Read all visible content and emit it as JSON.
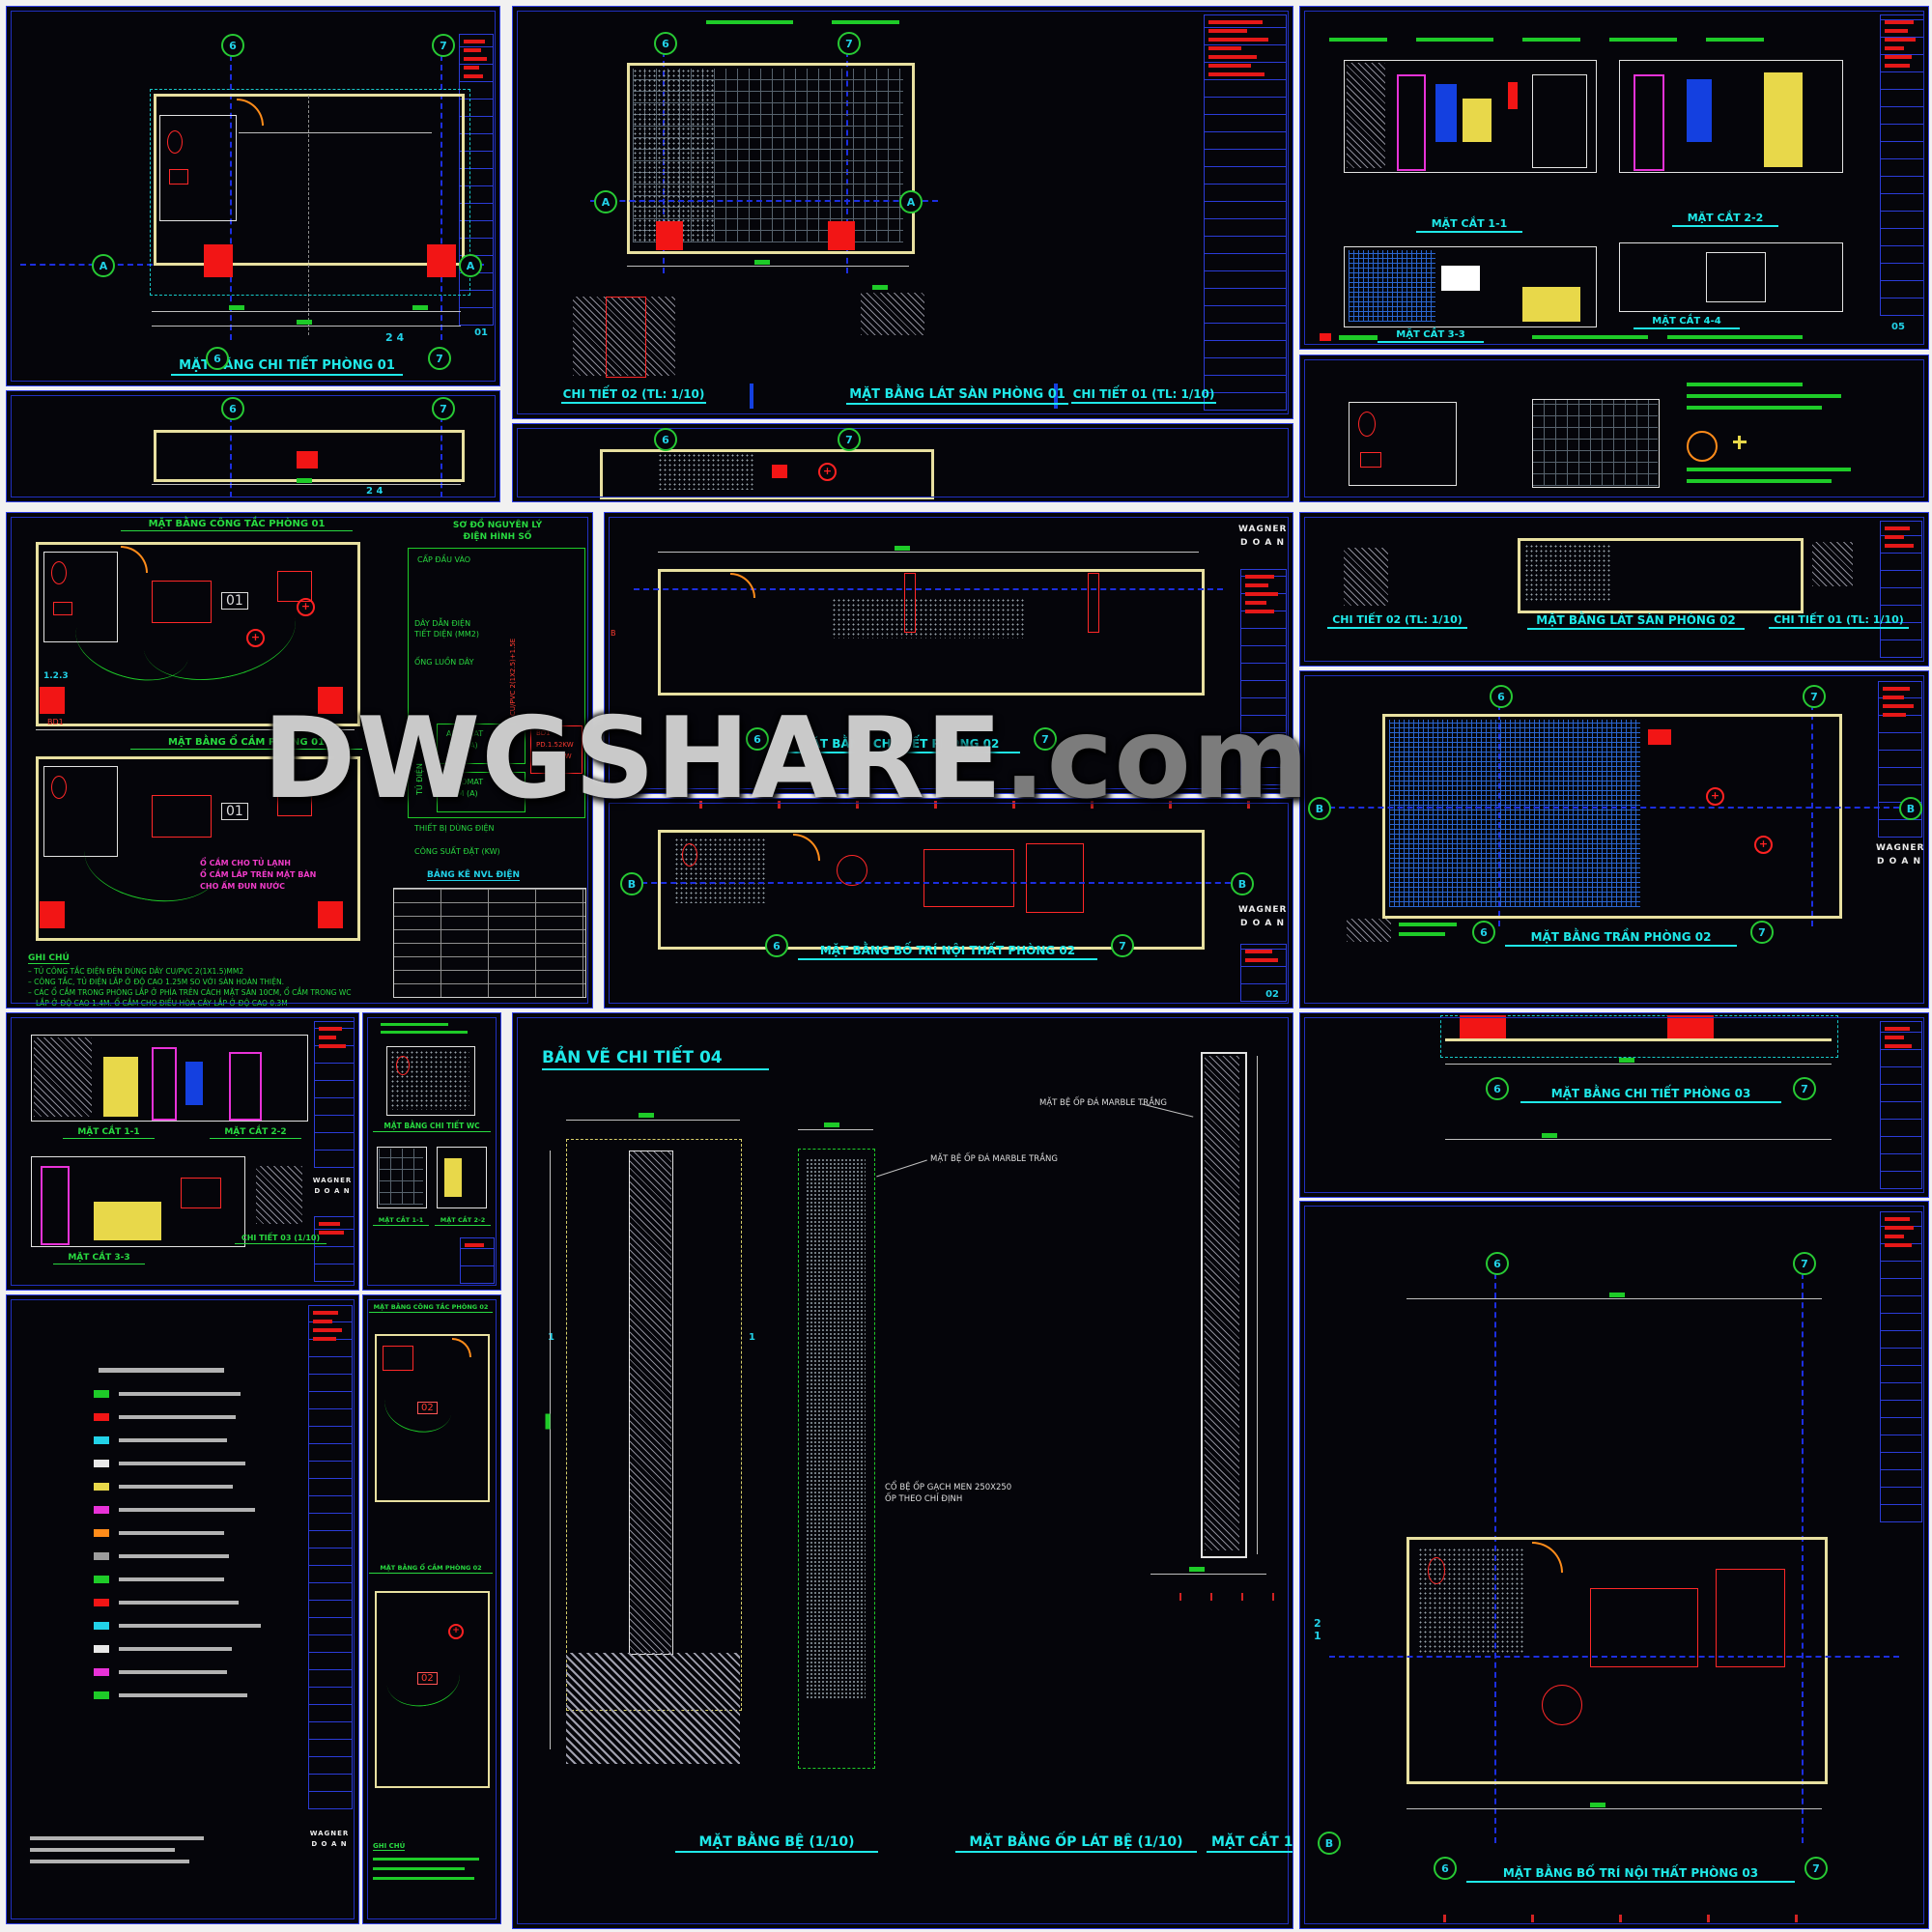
{
  "watermark": {
    "main": "DWGSHARE",
    "suffix": ".com"
  },
  "brand": {
    "name": "WAGNER",
    "sub": "D O A N"
  },
  "marks": {
    "b6": "6",
    "b7": "7",
    "axis_a": "A",
    "axis_b": "B",
    "sec_24": "2 4",
    "sec_2": "2",
    "sec_1": "1",
    "room_01": "01",
    "room_02": "02",
    "label_123": "1.2.3",
    "sheet_01": "01",
    "sheet_02": "02",
    "sheet_05": "05"
  },
  "titles": {
    "a1": "MẶT BẰNG CHI TIẾT PHÒNG 01",
    "b1_left": "CHI TIẾT 02 (TL: 1/10)",
    "b1_mid": "MẶT BẰNG LÁT SÀN PHÒNG 01",
    "b1_right": "CHI TIẾT 01 (TL: 1/10)",
    "c1_s11": "MẶT CẮT 1-1",
    "c1_s22": "MẶT CẮT 2-2",
    "c1_s33": "MẶT CẮT 3-3",
    "c1_s44": "MẶT CẮT 4-4",
    "d_top": "MẶT BẰNG CÔNG TẮC PHÒNG 01",
    "d_bottom": "MẶT BẰNG Ổ CẮM PHÒNG 01",
    "e1": "MẶT BẰNG CHI TIẾT PHÒNG 02",
    "e2": "MẶT BẰNG BỐ TRÍ NỘI THẤT PHÒNG 02",
    "f1_left": "CHI TIẾT 02 (TL: 1/10)",
    "f1_mid": "MẶT BẰNG LÁT SÀN PHÒNG 02",
    "f1_right": "CHI TIẾT 01 (TL: 1/10)",
    "f2": "MẶT BẰNG TRẦN PHÒNG 02",
    "g1_s11": "MẶT CẮT 1-1",
    "g1_s22": "MẶT CẮT 2-2",
    "g1_s33": "MẶT CẮT 3-3",
    "g1_ct03": "CHI TIẾT 03 (1/10)",
    "g2_wc": "MẶT BẰNG CHI TIẾT WC",
    "g2_s11": "MẶT CẮT 1-1",
    "g2_s22": "MẶT CẮT 2-2",
    "g4_top": "MẶT BẰNG CÔNG TẮC PHÒNG 02",
    "g4_bottom": "MẶT BẰNG Ổ CẮM PHÒNG 02",
    "h_header": "BẢN VẼ CHI TIẾT 04",
    "h_left": "MẶT BẰNG BỆ (1/10)",
    "h_mid": "MẶT BẰNG ỐP LÁT BỆ (1/10)",
    "h_right": "MẶT CẮT 1-1",
    "i1": "MẶT BẰNG CHI TIẾT PHÒNG 03",
    "i2": "MẶT BẰNG BỐ TRÍ NỘI THẤT PHÒNG 03"
  },
  "electrical": {
    "diagram_title1": "SƠ ĐỒ NGUYÊN LÝ",
    "diagram_title2": "ĐIỆN HÌNH SỐ",
    "cap_dau_vao": "CẤP ĐẦU VÀO",
    "aptomat": "APTOMAT",
    "idm": "IDM (A)",
    "tu_dien": "TỦ ĐIỆN",
    "device": "BD1",
    "pd": "PD.1.52KW",
    "ptt": "PTT:1.2KW",
    "day_dan": "DÂY DẪN ĐIỆN",
    "tiet_dien": "TIẾT DIỆN (MM2)",
    "ong_luon": "ỐNG LUỒN DÂY",
    "cable": "CU/PVC 2(1X2.5)+1.5E",
    "thiet_bi": "THIẾT BỊ DÙNG ĐIỆN",
    "cong_suat": "CÔNG SUẤT ĐẶT (KW)",
    "bang_ke": "BẢNG KÊ NVL ĐIỆN"
  },
  "notes": {
    "heading": "GHI CHÚ",
    "line1": "– TỦ CÔNG TẮC ĐIỆN ĐÈN DÙNG DÂY CU/PVC 2(1X1.5)MM2",
    "line2": "– CÔNG TẮC, TỦ ĐIỆN LẮP Ở ĐỘ CAO 1.25M SO VỚI SÀN HOÀN THIỆN.",
    "line3": "– CÁC Ổ CẮM TRONG PHÒNG LẮP Ở PHÍA TRÊN CÁCH MẶT SÀN 10CM, Ổ CẮM TRONG WC",
    "line4": "LẮP Ở ĐỘ CAO 1.4M. Ổ CẮM CHO ĐIỀU HÒA CÂY LẮP Ở ĐỘ CAO 0.3M",
    "g4_heading": "GHI CHÚ"
  },
  "annotations": {
    "socket1": "Ổ CẮM CHO TỦ LẠNH",
    "socket2": "Ổ CẮM LẮP TRÊN MẶT BÀN",
    "socket3": "CHO ẤM ĐUN NƯỚC",
    "marble": "MẶT BỆ ỐP ĐÁ MARBLE TRẮNG",
    "co_be": "CỔ BỆ ỐP GẠCH MEN 250X250",
    "op_theo": "ỐP THEO CHỈ ĐỊNH"
  },
  "legend": {
    "chip_colors": [
      "#1ecb28",
      "#f21515",
      "#22d2e8",
      "#e8e8e8",
      "#e8d84a",
      "#e832d8",
      "#ff8c1a",
      "#9c9c9c",
      "#1ecb28",
      "#f21515",
      "#22d2e8",
      "#e8e8e8",
      "#e832d8",
      "#1ecb28"
    ]
  },
  "colors": {
    "frame_blue": "#3040e8",
    "title_cyan": "#1fe9e9",
    "dim_green": "#1ecb28",
    "block_red": "#e51818",
    "wall_yellow": "#e8e0a0",
    "watermark_gray": "#d8d8d8"
  }
}
